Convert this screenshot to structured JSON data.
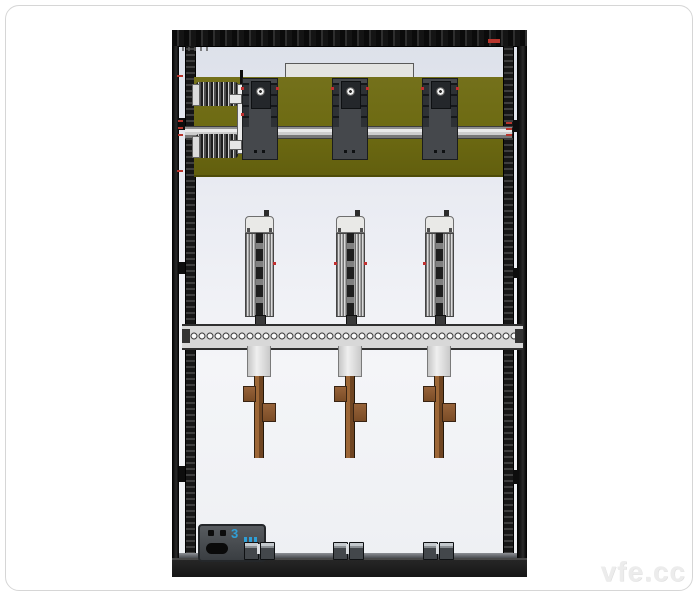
{
  "watermark": {
    "text": "vfe.cc"
  },
  "meter": {
    "marking": "3"
  },
  "colors": {
    "frame_black": "#161616",
    "panel_olive": "#6d6a12",
    "busbar_copper": "#8a5730",
    "rail_gray": "#d8d8d8",
    "interior_light": "#e9ebf1",
    "accent_red": "#b8352c",
    "accent_blue": "#2f9fd6",
    "card_border": "#d6d6d6",
    "watermark_gray": "#ececec"
  }
}
